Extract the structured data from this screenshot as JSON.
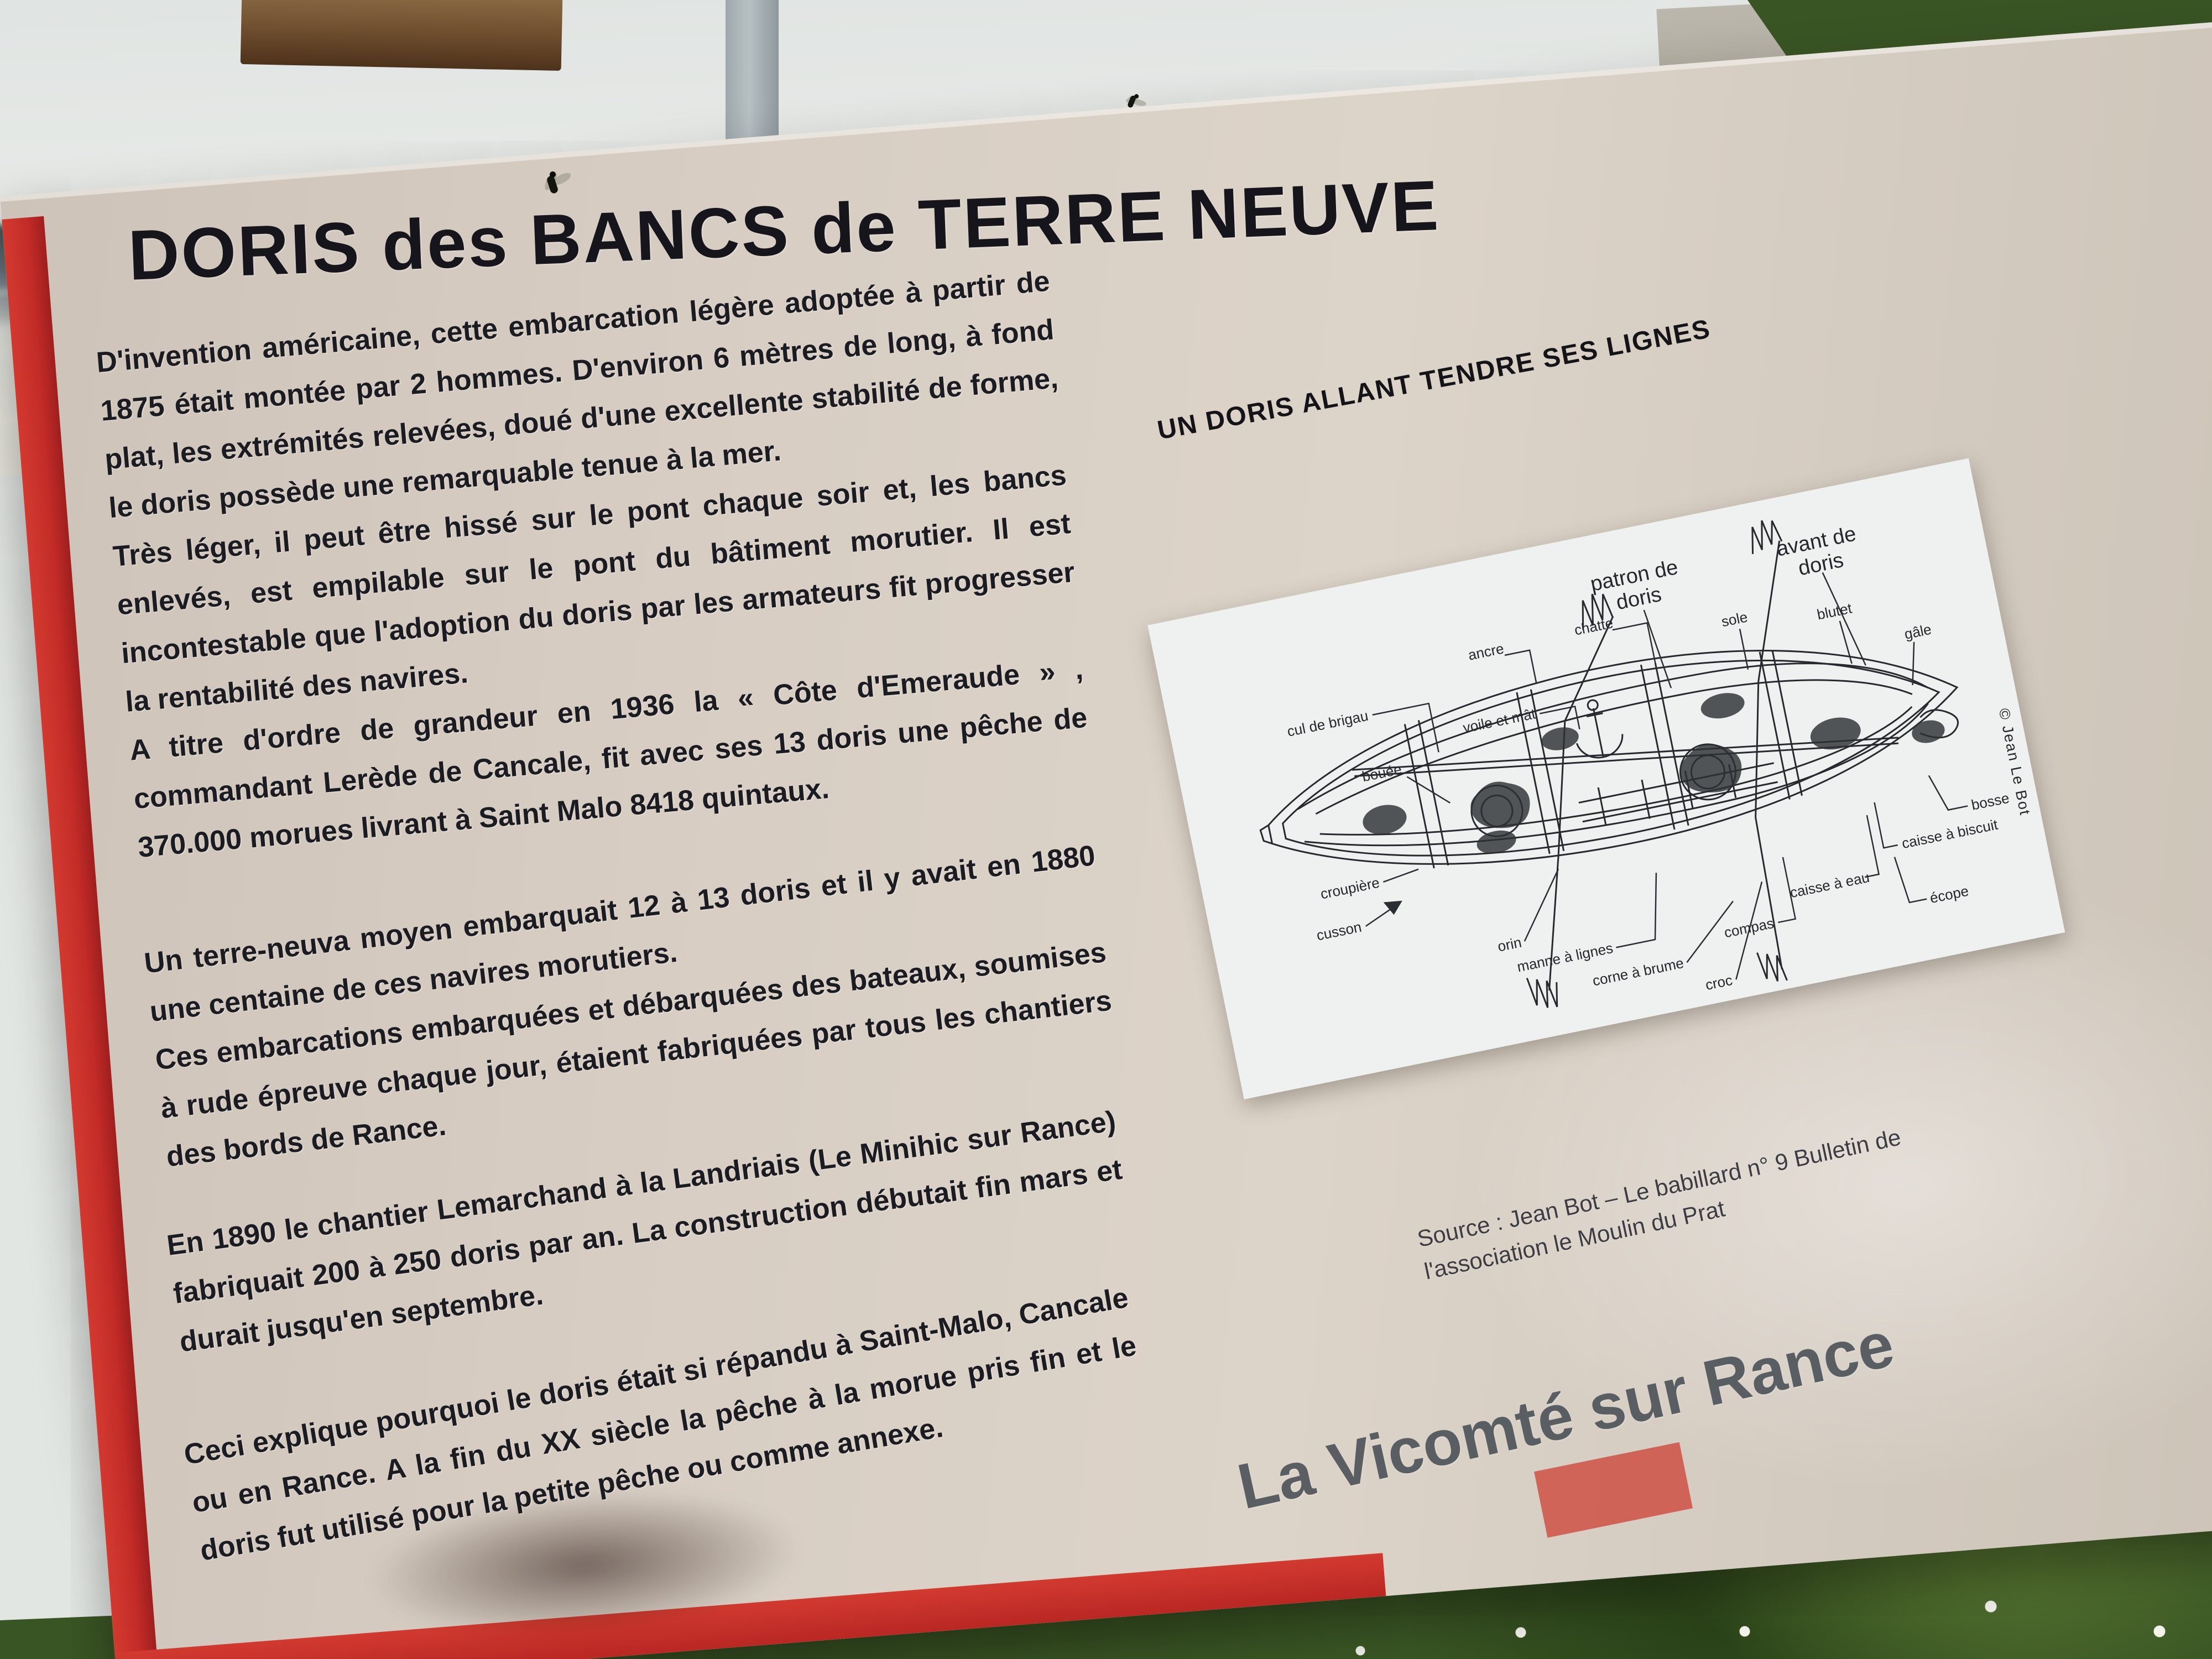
{
  "sign": {
    "title": "DORIS des BANCS de TERRE NEUVE",
    "paragraphs": [
      "D'invention américaine, cette embarcation légère adoptée à partir de 1875 était montée par 2 hommes. D'environ 6 mètres de long, à fond plat, les extrémités relevées, doué d'une excellente stabilité de forme, le doris possède une remarquable tenue à la mer.",
      "Très léger, il peut être hissé sur le pont chaque soir et, les bancs enlevés, est empilable sur le pont du bâtiment morutier. Il est incontestable que l'adoption du doris par les armateurs fit progresser la rentabilité des navires.",
      "A titre d'ordre de grandeur en 1936 la « Côte d'Emeraude » , commandant Lerède de Cancale, fit avec ses 13 doris une pêche de 370.000 morues livrant à Saint Malo 8418 quintaux.",
      "Un terre-neuva moyen embarquait 12 à 13 doris et il y avait en 1880 une centaine de ces navires morutiers.",
      "Ces embarcations embarquées et débarquées des bateaux, soumises à rude épreuve chaque jour, étaient fabriquées par tous les chantiers des bords de Rance.",
      "En 1890 le chantier Lemarchand à la Landriais (Le Minihic sur Rance) fabriquait 200 à 250 doris par an. La construction débutait fin mars et durait jusqu'en septembre.",
      "Ceci explique pourquoi le doris était si répandu à Saint-Malo, Cancale ou en Rance. A la fin du XX siècle la pêche à la morue pris fin et le doris fut utilisé pour la petite pêche ou comme annexe."
    ],
    "diagram": {
      "caption": "UN DORIS ALLANT TENDRE SES LIGNES",
      "credit": "© Jean Le Bot",
      "labels": [
        "patron de\ndoris",
        "avant de\ndoris",
        "voile et mât",
        "sole",
        "blutet",
        "gâle",
        "cul de brigau",
        "ancre",
        "chatte",
        "bouée",
        "croupière",
        "cusson",
        "orin",
        "manne à lignes",
        "corne à brume",
        "compas",
        "croc",
        "caisse à eau",
        "caisse à biscuit",
        "écope",
        "bosse"
      ]
    },
    "source_line1": "Source : Jean Bot – Le babillard n° 9 Bulletin de",
    "source_line2": "l'association le Moulin du Prat",
    "footer": "La Vicomté sur Rance",
    "colors": {
      "sign_red": "#c32b28",
      "sign_beige": "#d7cdc3",
      "panel_white": "#eef1ef",
      "ink": "#1b1b22",
      "footer_gray": "#4f555b"
    }
  }
}
